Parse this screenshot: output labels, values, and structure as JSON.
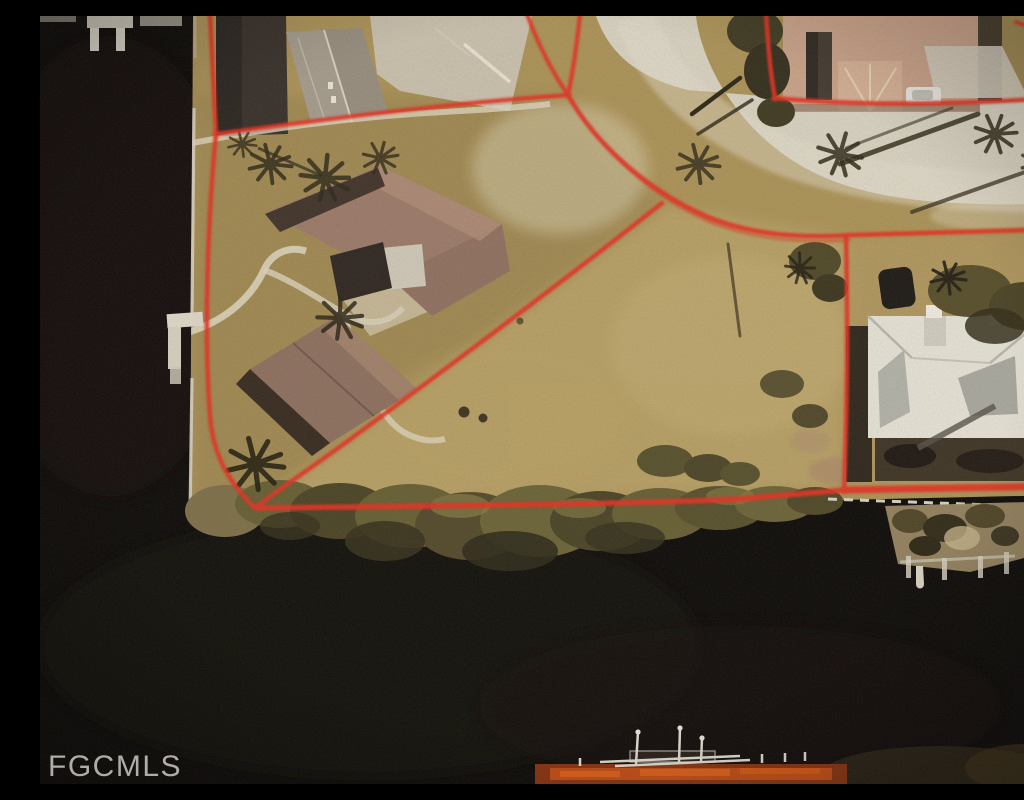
{
  "watermark": {
    "label": "FGCMLS"
  },
  "colors": {
    "water": "#0c0a08",
    "land": "#ab9257",
    "field_light": "#c2ac73",
    "road": "#d8d2c1",
    "concrete": "#c9c0ad",
    "boundary_red": "#e43022",
    "left_roof": "#9b7a69",
    "right_roof": "#e5e2d6",
    "top_right_roof": "#c9a289",
    "vegetation": "#57502c",
    "deep_shadow": "#2b2218",
    "seawall": "#d6d0c0",
    "dock": "#d8d2c2",
    "boat_glow": "#c84f15",
    "watermark_text": "#c6c3bd"
  },
  "features": [
    "dark canal water",
    "white seawall edge",
    "waterfront lot outlined in red boundary lines",
    "large vacant parcel",
    "curved residential street",
    "L-shaped house with brown roof",
    "second brown-roof wing",
    "house with white roof",
    "house with tan roof and white car",
    "palm trees and long shadows",
    "mangrove shoreline vegetation",
    "boat docks and pilings",
    "lit dock with boat at bottom"
  ]
}
